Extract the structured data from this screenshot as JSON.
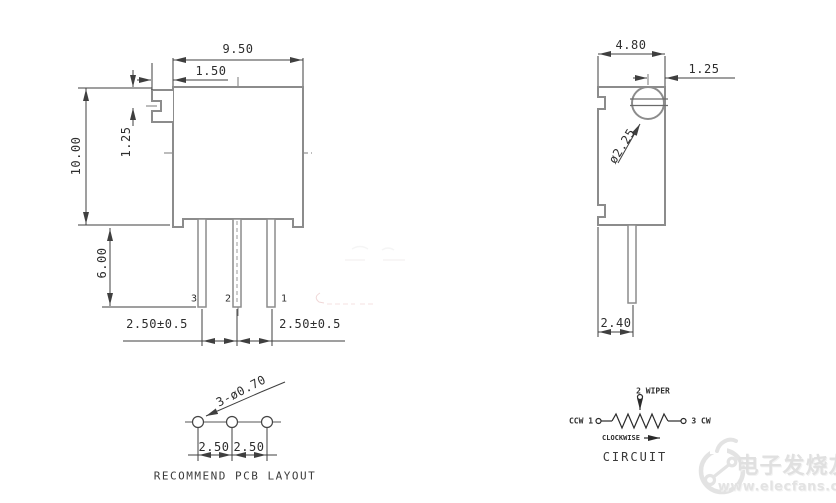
{
  "front_view": {
    "dim_body_width": "9.50",
    "dim_slot_inset": "1.50",
    "dim_body_height": "10.00",
    "dim_slot_center_offset": "1.25",
    "dim_pin_length": "6.00",
    "dim_pin_pitch_left": "2.50±0.5",
    "dim_pin_pitch_right": "2.50±0.5",
    "pin_labels": [
      "3",
      "2",
      "1"
    ]
  },
  "side_view": {
    "dim_body_depth": "4.80",
    "dim_screw_center_offset": "1.25",
    "dim_screw_diameter": "ø2.25",
    "dim_pin_offset": "2.40"
  },
  "pcb_layout": {
    "title": "RECOMMEND PCB LAYOUT",
    "dim_holes": "3-ø0.70",
    "dim_pitch_left": "2.50",
    "dim_pitch_right": "2.50"
  },
  "circuit": {
    "title": "CIRCUIT",
    "left_terminal": "CCW 1",
    "right_terminal": "3 CW",
    "wiper_terminal": "2 WIPER",
    "direction_label": "CLOCKWISE"
  },
  "watermark": {
    "brand": "电子发烧友",
    "site": "www.elecfans.com"
  },
  "colors": {
    "outline": "#8c8c8c",
    "dimension": "#3f3f3f",
    "centerline": "#7a7a7a",
    "watermark": "#e2e2e2",
    "background": "#ffffff"
  }
}
